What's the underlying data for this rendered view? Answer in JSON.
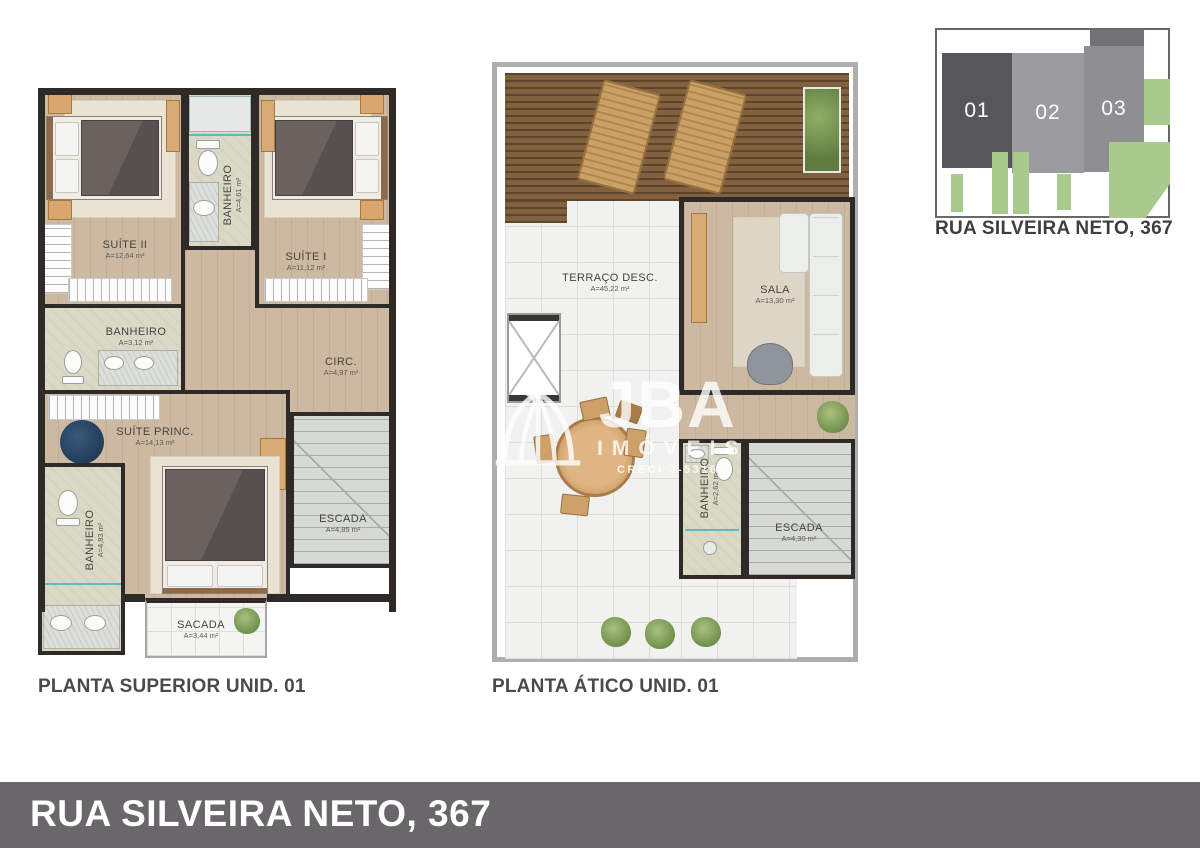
{
  "page": {
    "background": "#ffffff"
  },
  "watermark": {
    "brand": "JBA",
    "subtitle": "IMÓVEIS",
    "license": "CRECI J-5316",
    "icon": "dome-arch-logo"
  },
  "footer": {
    "address": "RUA SILVEIRA NETO, 367",
    "background": "#6a676a",
    "text_color": "#ffffff"
  },
  "site_diagram": {
    "caption": "RUA SILVEIRA NETO, 367",
    "units": [
      {
        "label": "01",
        "color": "#57575a"
      },
      {
        "label": "02",
        "color": "#9c9c9f"
      },
      {
        "label": "03",
        "color": "#8f8f92"
      }
    ],
    "green": "#a8ca8c"
  },
  "plan_superior": {
    "title": "PLANTA SUPERIOR UNID. 01",
    "rooms": {
      "suite2": {
        "name": "SUÍTE II",
        "area": "A=12,64 m²"
      },
      "banheiro_suite": {
        "name": "BANHEIRO",
        "area": "A=4,61 m²"
      },
      "suite1": {
        "name": "SUÍTE I",
        "area": "A=11,12 m²"
      },
      "banheiro_social": {
        "name": "BANHEIRO",
        "area": "A=3,12 m²"
      },
      "circ": {
        "name": "CIRC.",
        "area": "A=4,97 m²"
      },
      "suite_princ": {
        "name": "SUÍTE PRINC.",
        "area": "A=14,13 m²"
      },
      "banheiro_princ": {
        "name": "BANHEIRO",
        "area": "A=4,83 m²"
      },
      "escada": {
        "name": "ESCADA",
        "area": "A=4,85 m²"
      },
      "sacada": {
        "name": "SACADA",
        "area": "A=3,44 m²"
      }
    }
  },
  "plan_atico": {
    "title": "PLANTA ÁTICO UNID. 01",
    "rooms": {
      "terraco": {
        "name": "TERRAÇO DESC.",
        "area": "A=45,22 m²"
      },
      "sala": {
        "name": "SALA",
        "area": "A=13,30 m²"
      },
      "banheiro": {
        "name": "BANHEIRO",
        "area": "A=2,62 m²"
      },
      "escada": {
        "name": "ESCADA",
        "area": "A=4,30 m²"
      }
    }
  },
  "palette": {
    "wall": "#2e2a27",
    "wood_floor": "#cdb9a2",
    "bath_floor": "#dad9c6",
    "tile_floor": "#f1f1ef",
    "stairs_floor": "#d7d9d5",
    "deck": "#7d5c3e"
  }
}
